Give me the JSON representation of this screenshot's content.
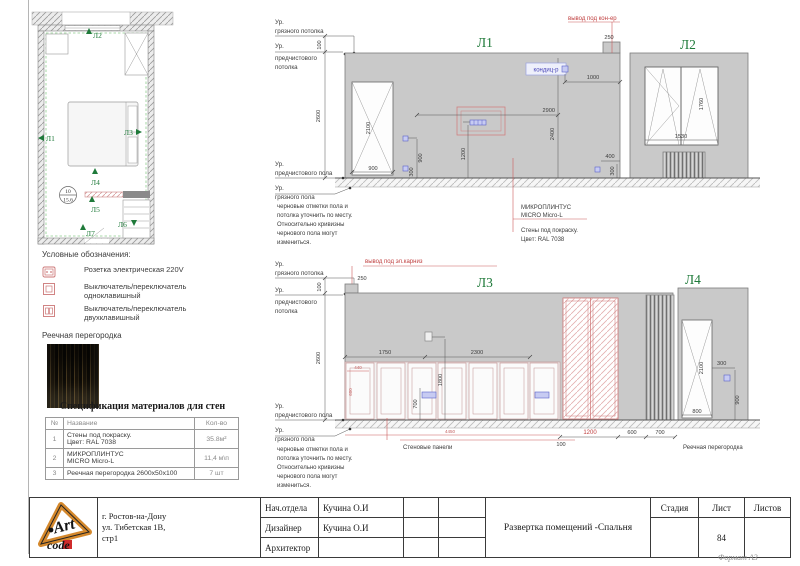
{
  "sheet": {
    "format": "Формат А3"
  },
  "plan": {
    "room_number": "10",
    "room_area": "15.6",
    "markers": {
      "l1": "Л1",
      "l2": "Л2",
      "l3": "Л3",
      "l4": "Л4",
      "l5": "Л5",
      "l6": "Л6",
      "l7": "Л7"
    }
  },
  "legend": {
    "title": "Условные обозначения:",
    "socket_label": "Розетка электрическая 220V",
    "switch1_l1": "Выключатель/переключатель",
    "switch1_l2": "одноклавишный",
    "switch2_l1": "Выключатель/переключатель",
    "switch2_l2": "двухклавишный",
    "partition_label": "Реечная перегородка"
  },
  "spec": {
    "title": "Спецификация материалов для стен",
    "headers": {
      "num": "№",
      "name": "Название",
      "qty": "Кол-во"
    },
    "rows": [
      {
        "num": "1",
        "name1": "Стены под покраску.",
        "name2": "Цвет: RAL 7038",
        "qty": "35.8м²"
      },
      {
        "num": "2",
        "name1": "МИКРОПЛИНТУС",
        "name2": "MICRO Micro-L",
        "qty": "11,4 м\\п"
      },
      {
        "num": "3",
        "name1": "Реечная перегородка 2600x50x100",
        "name2": "",
        "qty": "7 шт"
      }
    ]
  },
  "elev": {
    "titles": {
      "l1": "Л1",
      "l2": "Л2",
      "l3": "Л3",
      "l4": "Л4"
    },
    "levels": {
      "ur": "Ур.",
      "dirty_ceiling": "грязного потолка",
      "pre_ceiling1": "предчистового",
      "pre_ceiling2": "потолка",
      "pre_floor": "предчистового пола",
      "dirty_floor": "грязного пола"
    },
    "note": {
      "l1": "черновые отметки пола и",
      "l2": "потолка уточнить по месту.",
      "l3": "Относительно кривизны",
      "l4": "чернового пола могут",
      "l5": "измениться."
    },
    "callouts": {
      "cond_out": "вывод под кон-ер",
      "cond": "кондиц-р",
      "cornice_out": "вывод под эл.карниз",
      "skirting1": "МИКРОПЛИНТУС",
      "skirting2": "MICRO Micro-L",
      "paint1": "Стены под покраску.",
      "paint2": "Цвет: RAL 7038",
      "panels": "Стеновые панели",
      "partition": "Реечная перегородка"
    },
    "dims": {
      "v100": "100",
      "v250": "250",
      "v300": "300",
      "v400": "400",
      "v440": "440",
      "v600": "600",
      "v700": "700",
      "v800": "800",
      "v900": "900",
      "v1000": "1000",
      "v1200": "1200",
      "v1530": "1530",
      "v1750": "1750",
      "v1760": "1760",
      "v1800": "1800",
      "v2100": "2100",
      "v2300": "2300",
      "v2400": "2400",
      "v2600": "2600",
      "v2900": "2900",
      "v4450": "4450"
    }
  },
  "titleblock": {
    "address1": "г. Ростов-на-Дону",
    "address2": "ул. Тибетская 1В,",
    "address3": "стр1",
    "role1": "Нач.отдела",
    "role2": "Дизайнер",
    "role3": "Архитектор",
    "name1": "Кучина О.И",
    "name2": "Кучина О.И",
    "doc_title": "Развертка помещений -Спальня",
    "stage": "Стадия",
    "sheet_label": "Лист",
    "sheets_label": "Листов",
    "sheet_num": "84"
  },
  "logo": {
    "art": "Art",
    "code": "code"
  }
}
